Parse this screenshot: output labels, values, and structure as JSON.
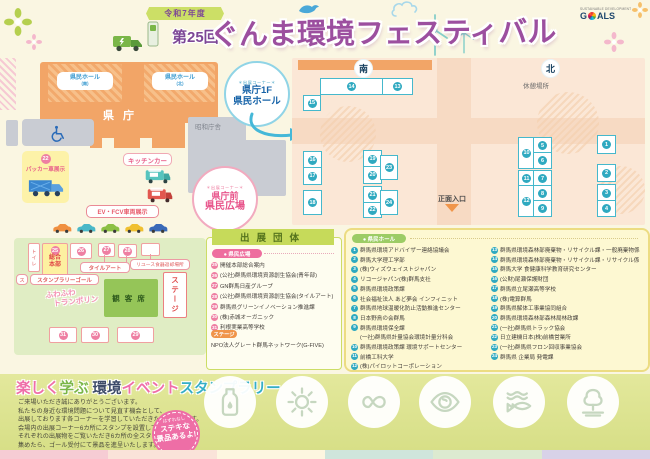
{
  "header": {
    "year_badge": "令和7年度",
    "edition_badge": "第25回",
    "title": "ぐんま環境フェスティバル",
    "sdgs_top": "SUSTAINABLE DEVELOPMENT",
    "sdgs_g": "G",
    "sdgs_rest": "ALS"
  },
  "map": {
    "kencho": "県庁",
    "hall_block_south": "県民ホール",
    "hall_block_south_sub": "(南)",
    "hall_block_north": "県民ホール",
    "hall_block_north_sub": "(北)",
    "showa": "昭和庁舎",
    "packer_num": "22",
    "packer_label": "パッカー車展示",
    "kitchen_label": "キッチンカー",
    "ev_label": "EV・FCV車両展示",
    "toilet": "トイレ",
    "callout_hall": {
      "tag": "＊出展コーナー＊",
      "line1": "県庁1F",
      "line2": "県民ホール"
    },
    "callout_plaza": {
      "tag": "＊出展コーナー＊",
      "line1": "県庁前",
      "line2": "県民広場"
    },
    "car_colors": [
      "#f09040",
      "#4ab8c8",
      "#8cc044",
      "#f0c030",
      "#3a6ab8"
    ]
  },
  "floor": {
    "south_badge": "南",
    "north_badge": "北",
    "rest_area": "休憩場所",
    "entrance": "正面入口",
    "booths": [
      {
        "n": "14",
        "x": 320,
        "y": 78,
        "w": 61,
        "h": 15
      },
      {
        "n": "13",
        "x": 382,
        "y": 78,
        "w": 29,
        "h": 15
      },
      {
        "n": "15",
        "x": 303,
        "y": 95,
        "w": 16,
        "h": 14
      },
      {
        "n": "16",
        "x": 303,
        "y": 151,
        "w": 17,
        "h": 16
      },
      {
        "n": "17",
        "x": 303,
        "y": 167,
        "w": 17,
        "h": 16
      },
      {
        "n": "18",
        "x": 303,
        "y": 190,
        "w": 17,
        "h": 23
      },
      {
        "n": "19",
        "x": 363,
        "y": 150,
        "w": 17,
        "h": 16
      },
      {
        "n": "20",
        "x": 363,
        "y": 166,
        "w": 17,
        "h": 16
      },
      {
        "n": "23",
        "x": 380,
        "y": 155,
        "w": 16,
        "h": 23
      },
      {
        "n": "21",
        "x": 363,
        "y": 186,
        "w": 17,
        "h": 16
      },
      {
        "n": "22",
        "x": 363,
        "y": 202,
        "w": 17,
        "h": 14
      },
      {
        "n": "24",
        "x": 380,
        "y": 190,
        "w": 16,
        "h": 23
      },
      {
        "n": "10",
        "x": 518,
        "y": 137,
        "w": 15,
        "h": 30
      },
      {
        "n": "5",
        "x": 533,
        "y": 137,
        "w": 17,
        "h": 15
      },
      {
        "n": "6",
        "x": 533,
        "y": 152,
        "w": 17,
        "h": 15
      },
      {
        "n": "11",
        "x": 518,
        "y": 170,
        "w": 15,
        "h": 15
      },
      {
        "n": "7",
        "x": 533,
        "y": 170,
        "w": 17,
        "h": 15
      },
      {
        "n": "12",
        "x": 518,
        "y": 185,
        "w": 15,
        "h": 30
      },
      {
        "n": "8",
        "x": 533,
        "y": 185,
        "w": 17,
        "h": 15
      },
      {
        "n": "9",
        "x": 533,
        "y": 200,
        "w": 17,
        "h": 15
      },
      {
        "n": "1",
        "x": 597,
        "y": 135,
        "w": 17,
        "h": 17
      },
      {
        "n": "2",
        "x": 597,
        "y": 164,
        "w": 17,
        "h": 16
      },
      {
        "n": "3",
        "x": 597,
        "y": 184,
        "w": 17,
        "h": 16
      },
      {
        "n": "4",
        "x": 597,
        "y": 200,
        "w": 17,
        "h": 15
      }
    ]
  },
  "green": {
    "hq_num": "25",
    "hq_label_1": "総合",
    "hq_label_2": "本部",
    "boxes": [
      {
        "n": "26",
        "x": 70,
        "y": 243,
        "w": 20,
        "h": 14
      },
      {
        "n": "27",
        "x": 98,
        "y": 243,
        "w": 15,
        "h": 12
      },
      {
        "n": "28",
        "x": 118,
        "y": 244,
        "w": 17,
        "h": 12
      },
      {
        "n": "",
        "x": 141,
        "y": 243,
        "w": 17,
        "h": 11
      },
      {
        "n": "31",
        "x": 49,
        "y": 327,
        "w": 26,
        "h": 14
      },
      {
        "n": "30",
        "x": 81,
        "y": 327,
        "w": 26,
        "h": 14
      },
      {
        "n": "29",
        "x": 117,
        "y": 327,
        "w": 35,
        "h": 14
      }
    ],
    "tile_art": "タイルアート",
    "reuse": "リユース食器返却場所",
    "stamp_mark": "ス",
    "stamp_goal": "スタンプラリーゴール",
    "trampoline_1": "ふわふわ",
    "trampoline_2": "トランポリン",
    "audience": "観客席",
    "stage": "ステージ"
  },
  "panels": {
    "title": "出展団体",
    "hiroba": {
      "badge": "● 県民広場",
      "items": [
        {
          "n": "25",
          "t": "開催本部総合案内"
        },
        {
          "n": "26",
          "t": "(公社)群馬県環境資源創生協会(青年部)"
        },
        {
          "n": "27",
          "t": "GN群馬日産グループ"
        },
        {
          "n": "28",
          "t": "(公社)群馬県環境資源創生協会(タイルアート)"
        },
        {
          "n": "29",
          "t": "群馬県グリーンイノベーション推進課"
        },
        {
          "n": "30",
          "t": "(株)赤城オーガニック"
        },
        {
          "n": "31",
          "t": "利根実業高等学校"
        }
      ],
      "stage_badge": "ステージ",
      "stage_text": "NPO法人グレート群馬ネットワーク(G-FIVE)"
    },
    "hall": {
      "badge": "● 県民ホール",
      "items_left": [
        {
          "n": "1",
          "t": "群馬県環境アドバイザー連絡協議会"
        },
        {
          "n": "2",
          "t": "群馬大学理工学部"
        },
        {
          "n": "3",
          "t": "(株)ウィズウェイストジャパン"
        },
        {
          "n": "4",
          "t": "リコージャパン(株)群馬支社"
        },
        {
          "n": "5",
          "t": "群馬県環境政策課"
        },
        {
          "n": "6",
          "t": "社会福祉法人 あど夢会 インフィニット"
        },
        {
          "n": "7",
          "t": "群馬県地球温暖化防止活動推進センター"
        },
        {
          "n": "8",
          "t": "日本野鳥の会群馬"
        },
        {
          "n": "9",
          "t": "群馬県環境保全課",
          "t2": "(一社)群馬県計量協会環境計量分科会"
        },
        {
          "n": "10",
          "t": "群馬県環境政策課 環境サポートセンター"
        },
        {
          "n": "11",
          "t": "前橋工科大学"
        },
        {
          "n": "12",
          "t": "(株)パイロットコーポレーション"
        }
      ],
      "items_right": [
        {
          "n": "13",
          "t": "群馬県環境森林部廃棄物・リサイクル課・一般廃棄物係"
        },
        {
          "n": "14",
          "t": "群馬県環境森林部廃棄物・リサイクル課・リサイクル係"
        },
        {
          "n": "15",
          "t": "群馬大学 食健康科学教育研究センター"
        },
        {
          "n": "16",
          "t": "(公財)尾瀬保護財団"
        },
        {
          "n": "17",
          "t": "群馬県立尾瀬高等学校"
        },
        {
          "n": "18",
          "t": "(株)電算群馬"
        },
        {
          "n": "19",
          "t": "群馬県解体工事業協同組合"
        },
        {
          "n": "20",
          "t": "群馬県環境森林部森林局林政課"
        },
        {
          "n": "21",
          "t": "(一社)群馬県トラック協会"
        },
        {
          "n": "22",
          "t": "日立建機日本(株)前橋営業所"
        },
        {
          "n": "23",
          "t": "(一社)群馬県フロン回収事業協会"
        },
        {
          "n": "24",
          "t": "群馬県 企業局 発電課"
        }
      ]
    }
  },
  "stamp": {
    "title_parts": [
      {
        "t": "楽しく",
        "c": "#ef6ea8"
      },
      {
        "t": "学ぶ",
        "c": "#7ab648"
      },
      {
        "t": " 環境",
        "c": "#3c4a68"
      },
      {
        "t": "イベント",
        "c": "#ef6ea8"
      },
      {
        "t": "スタンプラリー",
        "c": "#35aec6"
      }
    ],
    "body_lines": [
      "ご来場いただき誠にありがとうございます。",
      "私たちの身近な環境問題について見直す機会として、",
      "出展しております各コーナーを学習していただきたいと思います。",
      "会場内の出展コーナー6カ所にスタンプを設置しております。",
      "それぞれの出展物をご覧いただき6カ所の全スタンプを",
      "集めたら、ゴール受付にて景品を進呈いたします。"
    ],
    "burst_top": "はずれなし",
    "burst_line1": "ステキな",
    "burst_line2": "景品あるよ!",
    "icons": [
      "bottle",
      "sun",
      "infinity",
      "earth",
      "fish",
      "tree"
    ]
  },
  "colors": {
    "accent_purple": "#9c4f9f",
    "booth_teal": "#2fa9c0",
    "num_pink": "#ee7fa2",
    "building_orange": "#f2a567",
    "floor_peach": "#fbe7d6",
    "green_area": "#e0edc4"
  }
}
